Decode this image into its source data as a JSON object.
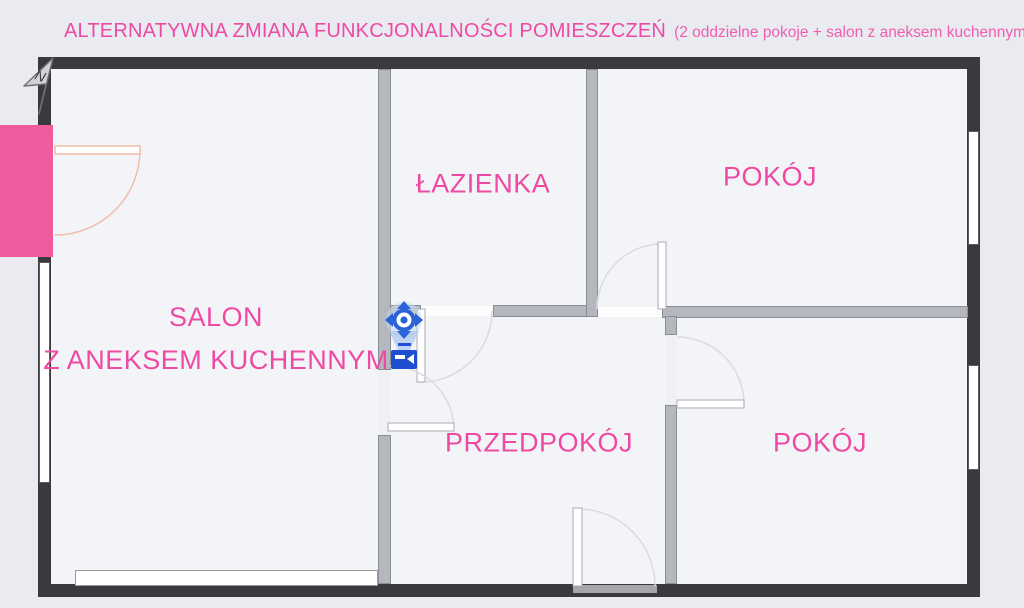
{
  "title": {
    "main": "ALTERNATYWNA ZMIANA FUNKCJONALNOŚCI POMIESZCZEŃ",
    "sub": "(2 oddzielne pokoje + salon z aneksem kuchennym)"
  },
  "compass": {
    "label": "N"
  },
  "rooms": {
    "lazienka": {
      "label": "ŁAZIENKA"
    },
    "pokoj_top": {
      "label": "POKÓJ"
    },
    "salon": {
      "line1": "SALON",
      "line2": "Z ANEKSEM KUCHENNYM"
    },
    "przedpokoj": {
      "label": "PRZEDPOKÓJ"
    },
    "pokoj_bottom": {
      "label": "POKÓJ"
    }
  },
  "icons": {
    "compass": "north-arrow",
    "camera": "camera-viewpoint-marker"
  },
  "colors": {
    "accent_pink": "#ee4aa3",
    "entrance_highlight": "#ee5c9f",
    "outer_wall": "#3a3a3e",
    "interior_wall": "#b4b7bd",
    "camera_blue": "#2a62d8",
    "entrance_door_arc": "#f2bca8",
    "door_arc": "#d9dbe0",
    "background": "#e9ebf1",
    "floor": "#f3f4f8"
  }
}
